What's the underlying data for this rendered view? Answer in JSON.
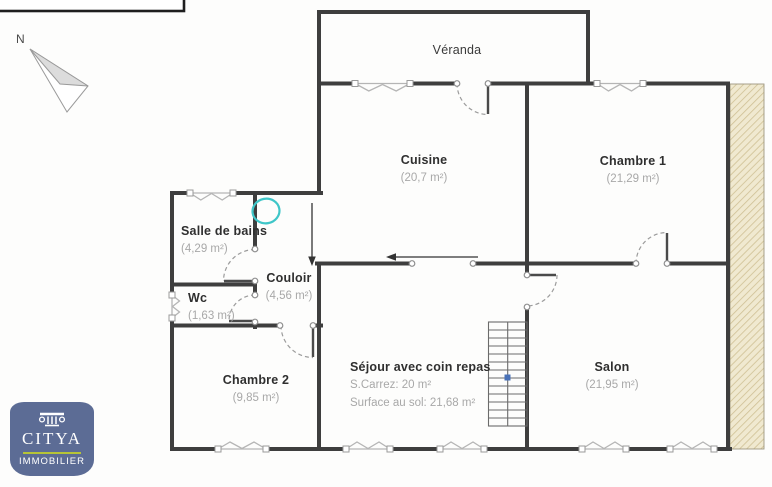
{
  "compass": {
    "north_label": "N"
  },
  "rooms": {
    "veranda": {
      "name": "Véranda"
    },
    "cuisine": {
      "name": "Cuisine",
      "area": "(20,7 m²)"
    },
    "chambre1": {
      "name": "Chambre 1",
      "area": "(21,29 m²)"
    },
    "salle_de_bains": {
      "name": "Salle de bains",
      "area": "(4,29 m²)"
    },
    "couloir": {
      "name": "Couloir",
      "area": "(4,56 m²)"
    },
    "wc": {
      "name": "Wc",
      "area": "(1,63 m²)"
    },
    "chambre2": {
      "name": "Chambre 2",
      "area": "(9,85 m²)"
    },
    "sejour": {
      "name": "Séjour avec coin repas",
      "carrez": "S.Carrez: 20 m²",
      "floor_area": "Surface au sol: 21,68 m²"
    },
    "salon": {
      "name": "Salon",
      "area": "(21,95 m²)"
    }
  },
  "logo": {
    "brand": "CITYA",
    "tagline": "IMMOBILIER"
  },
  "colors": {
    "wall": "#3e3e3e",
    "room_name": "#2f2f2f",
    "area_text": "#a8a8a8",
    "window_symbol": "#b5b5b5",
    "door_arc": "#9c9c9c",
    "door_leaf": "#4a4a4a",
    "stair_line": "#6b6b6b",
    "stair_marker": "#4a72b8",
    "hatch_fill": "#f0e9d0",
    "hatch_line": "#cfc094",
    "annotation_arrow": "#333333",
    "highlight_teal": "#3fc6c8",
    "compass_fill": "#dcdcdc",
    "compass_outline": "#9a9a9a",
    "logo_bg": "#5c6c95",
    "logo_accent_green": "#b6c437",
    "logo_text": "#ffffff"
  }
}
